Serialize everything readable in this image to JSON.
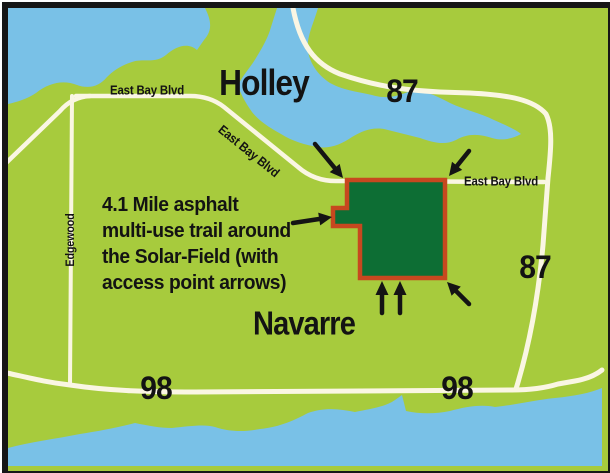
{
  "labels": {
    "holley": "Holley",
    "navarre": "Navarre",
    "east_bay_blvd_west": "East Bay Blvd",
    "east_bay_blvd_mid": "East Bay Blvd",
    "east_bay_blvd_east": "East Bay Blvd",
    "edgewood": "Edgewood",
    "route_87_north": "87",
    "route_87_south": "87",
    "route_98_west": "98",
    "route_98_east": "98"
  },
  "annotation": {
    "lines": [
      "4.1 Mile asphalt",
      "multi-use trail around",
      "the Solar-Field (with",
      "access point arrows)"
    ]
  },
  "colors": {
    "land": "#a7cb3d",
    "water": "#79c1e7",
    "road": "#faf6e3",
    "solar_field_fill": "#0d6e34",
    "solar_field_border": "#c7481f",
    "arrow": "#141414",
    "frame": "#161616",
    "text": "#131313"
  }
}
